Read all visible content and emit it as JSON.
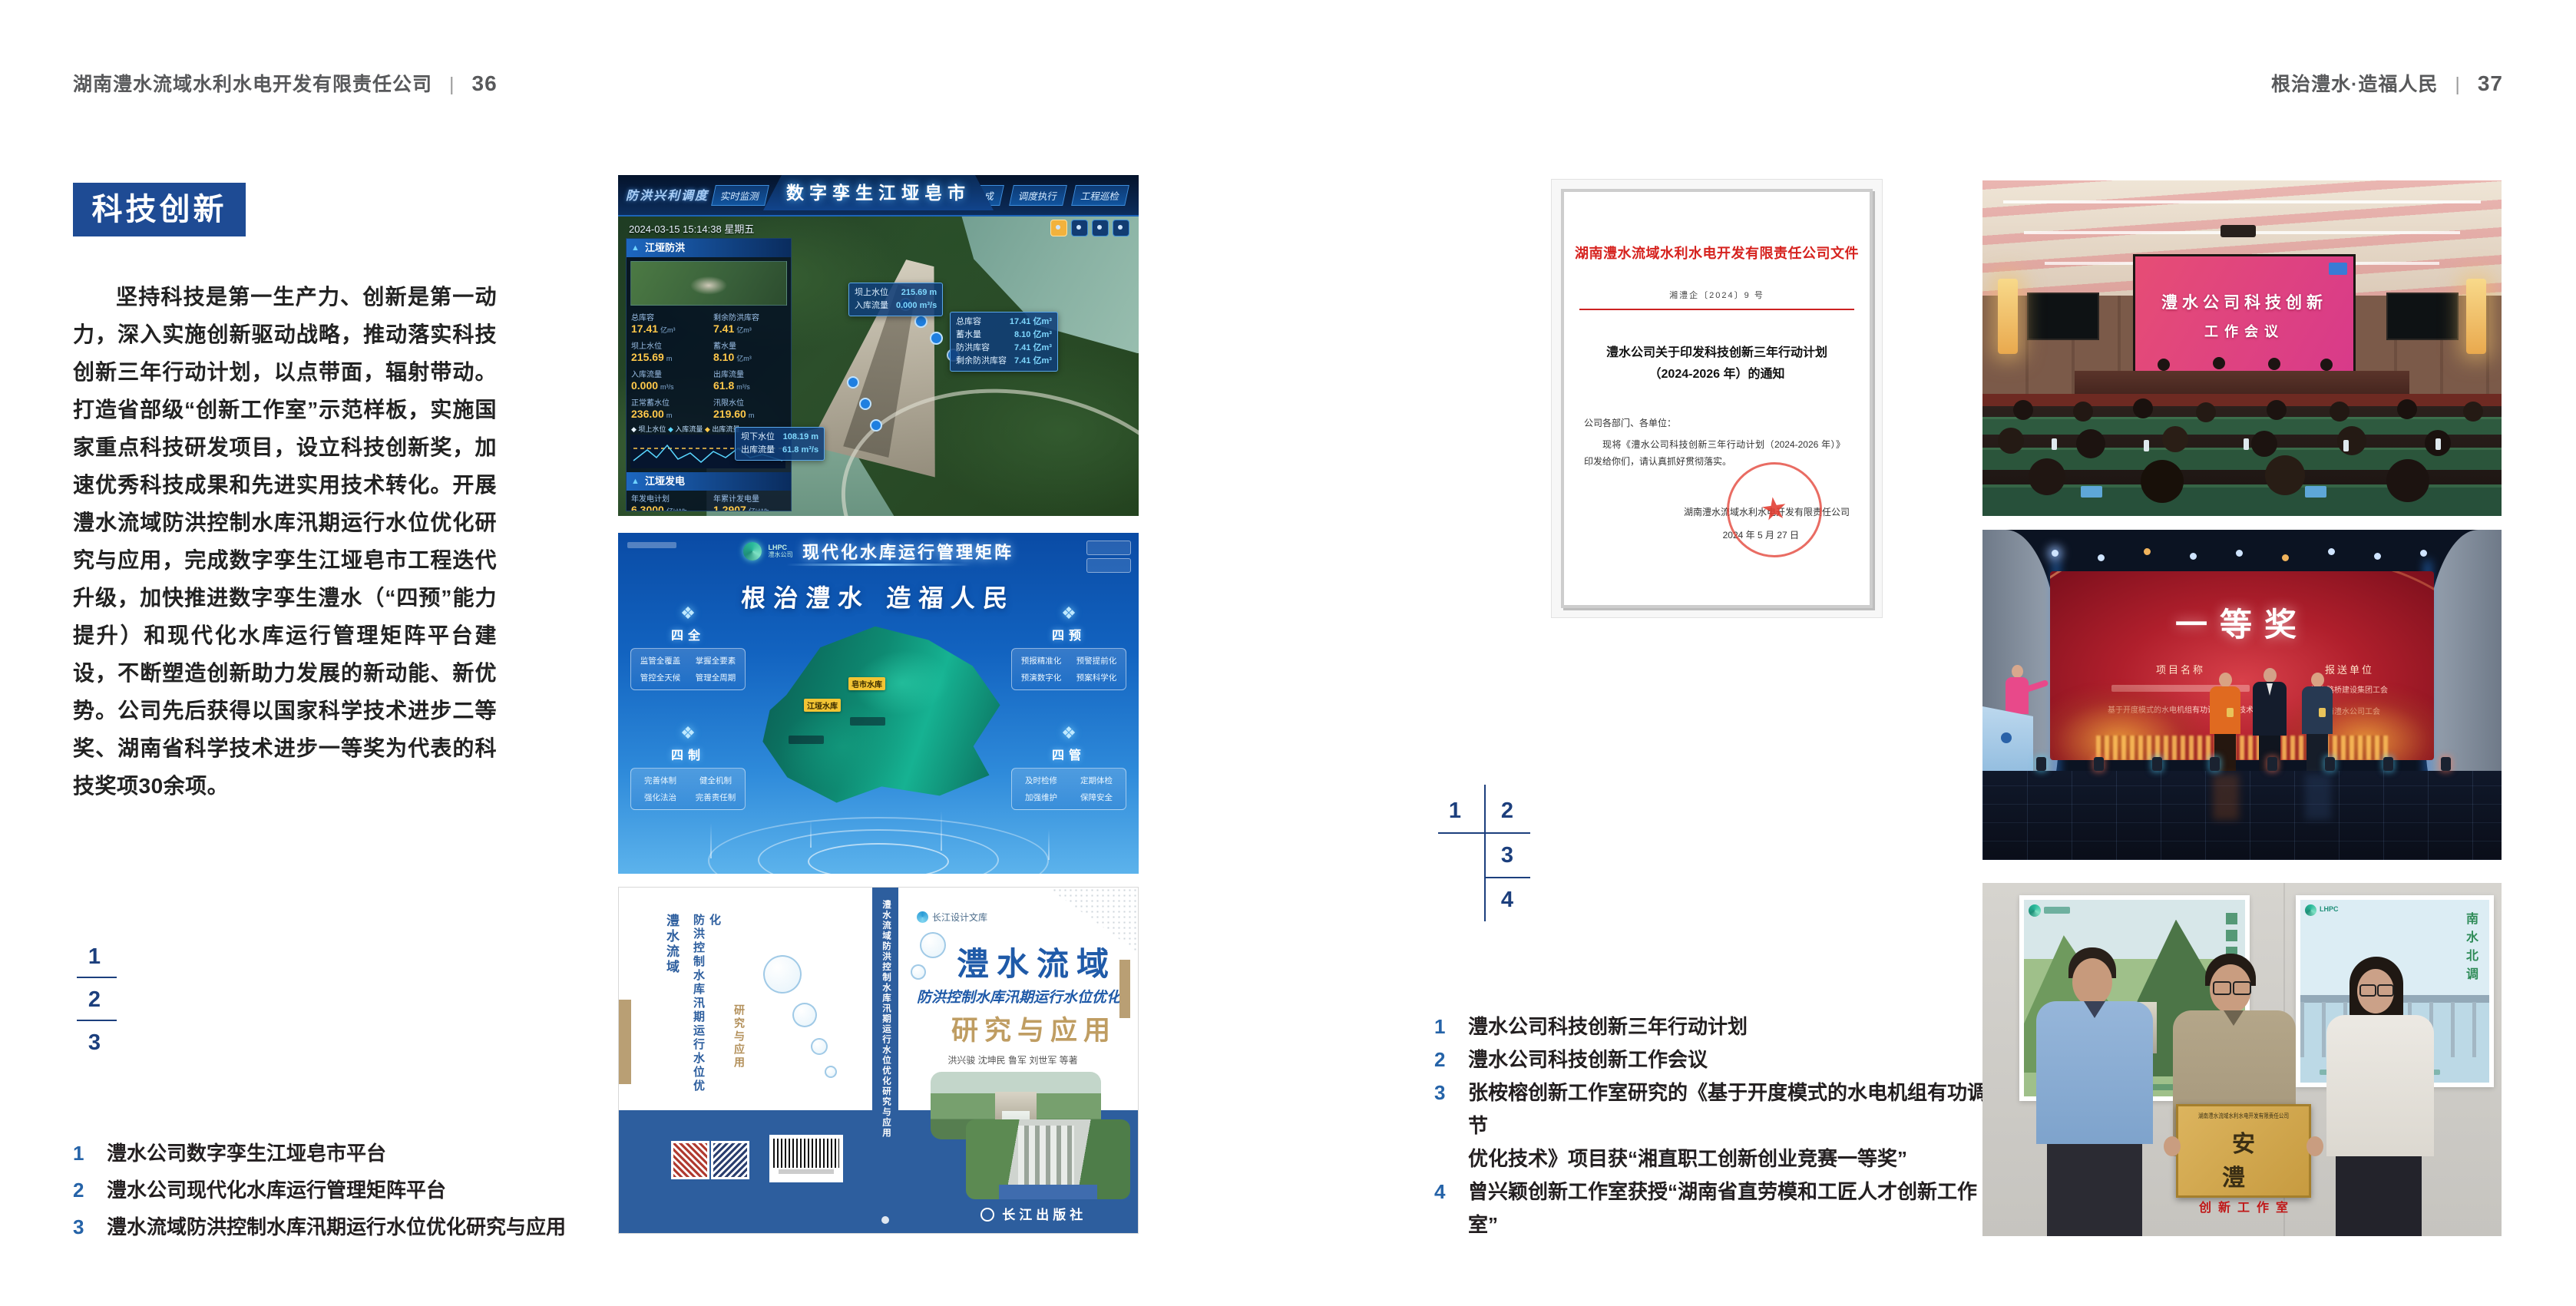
{
  "colors": {
    "accent_blue": "#1e4b94",
    "grid_number_blue": "#1c3f7d",
    "caption_number_blue": "#2563a8",
    "header_gray": "#58595b",
    "doc_red": "#d6231f",
    "book_blue": "#2d5e9e",
    "gold": "#bf9d62"
  },
  "page_left": {
    "header": {
      "company": "湖南澧水流域水利水电开发有限责任公司",
      "separator": "|",
      "page_no": "36"
    },
    "section_title": "科技创新",
    "body_text": "坚持科技是第一生产力、创新是第一动力，深入实施创新驱动战略，推动落实科技创新三年行动计划，以点带面，辐射带动。打造省部级“创新工作室”示范样板，实施国家重点科技研发项目，设立科技创新奖，加速优秀科技成果和先进实用技术转化。开展澧水流域防洪控制水库汛期运行水位优化研究与应用，完成数字孪生江垭皂市工程迭代升级，加快推进数字孪生澧水（“四预”能力提升）和现代化水库运行管理矩阵平台建设，不断塑造创新助力发展的新动能、新优势。公司先后获得以国家科学技术进步二等奖、湖南省科学技术进步一等奖为代表的科技奖项30余项。",
    "figure_numbers": [
      "1",
      "2",
      "3"
    ],
    "captions": [
      {
        "no": "1",
        "text": "澧水公司数字孪生江垭皂市平台"
      },
      {
        "no": "2",
        "text": "澧水公司现代化水库运行管理矩阵平台"
      },
      {
        "no": "3",
        "text": "澧水流域防洪控制水库汛期运行水位优化研究与应用"
      }
    ],
    "fig_twin": {
      "corner_label": "防洪兴利调度",
      "title": "数字孪生江垭皂市",
      "tabs_left": [
        "实时监测",
        "洪水预报",
        "防洪预警"
      ],
      "tabs_right": [
        "风险预判",
        "预案生成",
        "调度执行",
        "工程巡检"
      ],
      "timestamp": "2024-03-15 15:14:38 星期五",
      "panel_flood_title": "江垭防洪",
      "flood_stats": [
        {
          "k": "总库容",
          "v": "17.41",
          "u": "亿m³"
        },
        {
          "k": "剩余防洪库容",
          "v": "7.41",
          "u": "亿m³"
        },
        {
          "k": "坝上水位",
          "v": "215.69",
          "u": "m"
        },
        {
          "k": "蓄水量",
          "v": "8.10",
          "u": "亿m³"
        },
        {
          "k": "入库流量",
          "v": "0.000",
          "u": "m³/s"
        },
        {
          "k": "出库流量",
          "v": "61.8",
          "u": "m³/s"
        },
        {
          "k": "正常蓄水位",
          "v": "236.00",
          "u": "m"
        },
        {
          "k": "汛限水位",
          "v": "219.60",
          "u": "m"
        }
      ],
      "legend": [
        "坝上水位",
        "入库流量",
        "出库流量"
      ],
      "panel_power_title": "江垭发电",
      "power_stats": [
        {
          "k": "年发电计划",
          "v": "6.3000",
          "u": "亿kWh"
        },
        {
          "k": "年累计发电量",
          "v": "1.2907",
          "u": "亿kWh"
        },
        {
          "k": "月累计发电量",
          "v": "3359.21",
          "u": "万kWh"
        },
        {
          "k": "当前出力",
          "v": "0.00",
          "u": "MW"
        },
        {
          "k": "发电流量",
          "v": "0.00",
          "u": "m³/s"
        },
        {
          "k": "弃水流量",
          "v": "0.00",
          "u": "m³/s"
        }
      ],
      "callout_up": [
        {
          "k": "坝上水位",
          "v": "215.69 m"
        },
        {
          "k": "入库流量",
          "v": "0.000 m³/s"
        }
      ],
      "callout_right": [
        {
          "k": "总库容",
          "v": "17.41 亿m³"
        },
        {
          "k": "蓄水量",
          "v": "8.10 亿m³"
        },
        {
          "k": "防洪库容",
          "v": "7.41 亿m³"
        },
        {
          "k": "剩余防洪库容",
          "v": "7.41 亿m³"
        }
      ],
      "callout_down": [
        {
          "k": "坝下水位",
          "v": "108.19 m"
        },
        {
          "k": "出库流量",
          "v": "61.8 m³/s"
        }
      ]
    },
    "fig_matrix": {
      "logo_abbr": "LHPC",
      "logo_name": "澧水公司",
      "title": "现代化水库运行管理矩阵",
      "slogan": "根治澧水 造福人民",
      "groups": [
        {
          "name": "四全",
          "items": [
            "监管全覆盖",
            "掌握全要素",
            "管控全天候",
            "管理全周期"
          ]
        },
        {
          "name": "四预",
          "items": [
            "预报精准化",
            "预警提前化",
            "预演数字化",
            "预案科学化"
          ]
        },
        {
          "name": "四制",
          "items": [
            "完善体制",
            "健全机制",
            "强化法治",
            "完善责任制"
          ]
        },
        {
          "name": "四管",
          "items": [
            "及时检修",
            "定期体检",
            "加强维护",
            "保障安全"
          ]
        }
      ],
      "map_labels": [
        "皂市水库",
        "江垭水库"
      ]
    },
    "fig_book": {
      "series": "长江设计文库",
      "title1": "澧水流域",
      "title2": "防洪控制水库汛期运行水位优化",
      "title3": "研究与应用",
      "authors": "洪兴骏  沈坤民  鲁军  刘世军  等著",
      "publisher": "长江出版社",
      "spine_text": "澧水流域防洪控制水库汛期运行水位优化研究与应用"
    }
  },
  "page_right": {
    "header": {
      "slogan": "根治澧水·造福人民",
      "separator": "|",
      "page_no": "37"
    },
    "figure_numbers": [
      "1",
      "2",
      "3",
      "4"
    ],
    "captions": [
      {
        "no": "1",
        "text": "澧水公司科技创新三年行动计划"
      },
      {
        "no": "2",
        "text": "澧水公司科技创新工作会议"
      },
      {
        "no": "3",
        "text": "张桉榕创新工作室研究的《基于开度模式的水电机组有功调节",
        "text2": "优化技术》项目获“湘直职工创新创业竞赛一等奖”"
      },
      {
        "no": "4",
        "text": "曾兴颖创新工作室获授“湖南省直劳模和工匠人才创新工作室”"
      }
    ],
    "document": {
      "title": "湖南澧水流域水利水电开发有限责任公司文件",
      "doc_no": "湘澧企〔2024〕9 号",
      "subject1": "澧水公司关于印发科技创新三年行动计划",
      "subject2": "（2024-2026 年）的通知",
      "salutation": "公司各部门、各单位：",
      "body": "现将《澧水公司科技创新三年行动计划（2024-2026 年）》印发给你们，请认真抓好贯彻落实。",
      "signer": "湖南澧水流域水利水电开发有限责任公司",
      "date": "2024 年 5 月 27 日"
    },
    "photo_meeting": {
      "screen_line1": "澧水公司科技创新",
      "screen_line2": "工作会议"
    },
    "photo_award": {
      "screen_title": "一等奖",
      "col1_label": "项目名称",
      "col2_label": "报送单位",
      "project_line": "基于开度模式的水电机组有功调节优化技术",
      "unit_line1": "湖南路桥建设集团工会",
      "unit_line2": "湖南澧水公司工会"
    },
    "photo_plaque": {
      "plaque_header": "湖南澧水流域水利水电开发有限责任公司",
      "plaque_title": "安 澧",
      "plaque_sub": "创新工作室",
      "poster_logo": "LHPC",
      "poster_right_text": "南水北调"
    }
  }
}
